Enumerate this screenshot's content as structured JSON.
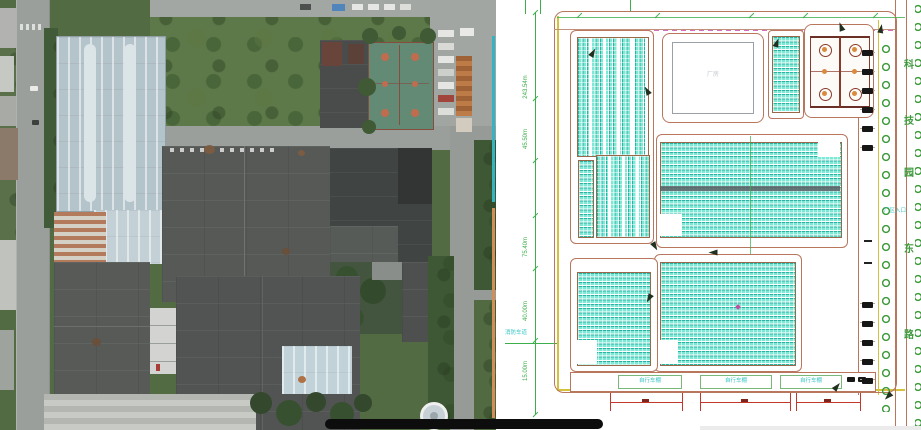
{
  "scene": {
    "left": "aerial-orthophoto-of-factory-campus",
    "right": "photovoltaic-site-plan-drawing"
  },
  "plan": {
    "street_name": {
      "full": "科技园东路",
      "chars": [
        "科",
        "技",
        "园",
        "东",
        "路"
      ]
    },
    "dims_left": [
      "243.54m",
      "45.50m",
      "75.40m",
      "40.00m",
      "15.00m"
    ],
    "labels": {
      "fire_lane": "消防车道",
      "entrance": "厂区入口",
      "white_building": "厂房",
      "sheds": [
        "自行车棚",
        "自行车棚",
        "自行车棚"
      ]
    },
    "colors": {
      "panel_fill": "#7ce8d5",
      "panel_line": "#28b3a3",
      "outline_brown": "#b8765c",
      "dim_green": "#3cae4a",
      "boundary_yellow": "#d4c13c",
      "court_red": "#8a3a2a",
      "court_orange": "#d98a3c",
      "tree_green": "#3f9a3d",
      "cyan_label": "#35c4c4",
      "red_dim": "#c0392b",
      "magenta": "#d96ec0"
    }
  },
  "photo": {
    "colors": {
      "roof_dark": "#545855",
      "roof_blue": "#b5c6ce",
      "vegetation": "#4f6b3d",
      "road": "#9aa09d",
      "court_green": "#5f8b74",
      "container_orange": "#c47a40"
    }
  },
  "overlay": {
    "video_bar_color": "#0d0d0d"
  }
}
